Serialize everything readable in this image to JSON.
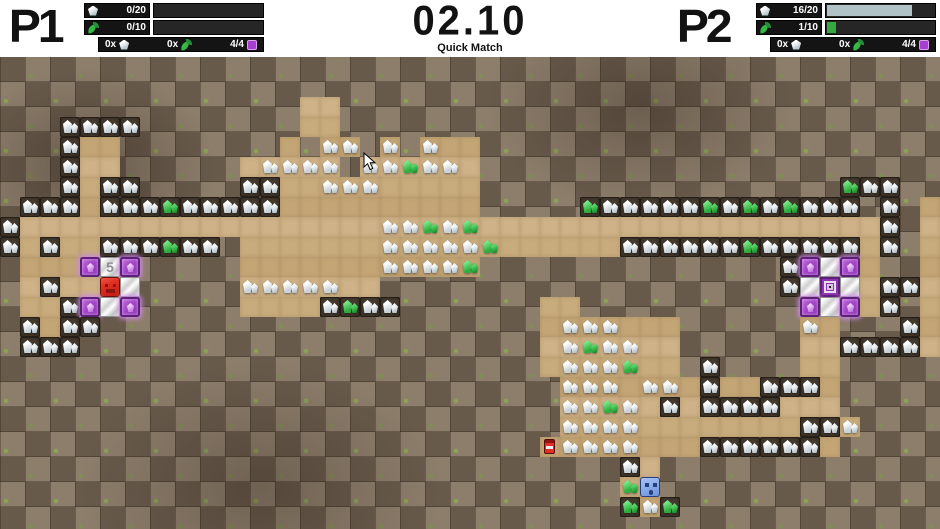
{
  "hud": {
    "timer": "02.10",
    "mode": "Quick Match",
    "p1": {
      "label": "P1",
      "gem": {
        "value": "0/20",
        "fill_pct": 0,
        "fill_color": "#b0c2c6"
      },
      "leaf": {
        "value": "0/10",
        "fill_pct": 0,
        "fill_color": "#35a93f"
      },
      "inv": {
        "gems": "0x",
        "leaves": "0x",
        "blocks": "4/4"
      }
    },
    "p2": {
      "label": "P2",
      "gem": {
        "value": "16/20",
        "fill_pct": 80,
        "fill_color": "#b0c2c6"
      },
      "leaf": {
        "value": "1/10",
        "fill_pct": 10,
        "fill_color": "#35a93f"
      },
      "inv": {
        "gems": "0x",
        "leaves": "0x",
        "blocks": "4/4"
      }
    },
    "icons": {
      "gem": "gem-icon",
      "leaf": "leaf-icon",
      "block": "block-icon"
    }
  },
  "board": {
    "cols": 47,
    "rows": 24,
    "tile": 20,
    "five_label": "5",
    "legend": {
      "D": "dirt",
      "S": "dug-sand",
      "w": "white-gem-on-sand",
      "g": "green-gem-on-sand",
      "W": "white-gem-in-dirt",
      "G": "green-gem-in-dirt",
      "P": "purple-crystal-block",
      "M": "marble-block",
      "5": "numbered-marble-block",
      "C": "base-center-marker",
      "R": "player-red",
      "B": "player-blue",
      "t": "tnt-canister"
    },
    "map": [
      "DDDDDDDDDDDDDDDDDDDDDDDDDDDDDDDDDDDDDDDDDDDDDDD",
      "DDDDDDDDDDDDDDDDDDDDDDDDDDDDDDDDDDDDDDDDDDDDDDD",
      "DDDDDDDDDDDDDDDSSDDDDDDDDDDDDDDDDDDDDDDDDDDDDDD",
      "DDDWWWWDDDDDDDDSSDDDDDDDDDDDDDDDDDDDDDDDDDDDDDD",
      "DDDWSSDDDDDDDDSDwwDwDwSSDDDDDDDDDDDDDDDDDDDDDDD",
      "DDDWSSDDDDDDSwwwwDwwgwwSDDDDDDDDDDDDDDDDDDDDDDD",
      "DDDWSWWDDDDDWWSSwwwSSSSSDDDDDDDDDDDDDDDDDDGWWDD",
      "DWWWSWWWGWWWWWSSSSSSSSSSDDDDDGWWWWWGWGWGWWWDWDS",
      "WSSSSSSSSSSSSSSSSSSwwgwgSSSSSSSSSSSSSSSSSSSSWDS",
      "WSWSSWWWGWWDSSSSSSSwwwwwgSSSSSSWWWWWWGWWWWWSWDS",
      "DSSSP5PDDDDDSSSSSSSwwwwgDDDDDDDDDDDDDDDWPMPSDDS",
      "DSWSSRMDDDDDwwwwwSSDDDDDDDDDDDDDDDDDDDDWMCMSWWS",
      "DSSWPMPDDDDDSSSSWGWWDDDDDDDSSDDDDDDDDDDDPMPSWDS",
      "DWSWWDDDDDDDDDDDDDDDDDDDDDDSwwwSSSDDDDDDwSDDDWS",
      "DWWWDDDDDDDDDDDDDDDDDDDDDDDSwgwwSSDDDDDDSSWWWWS",
      "DDDDDDDDDDDDDDDDDDDDDDDDDDDSwwwgSSDWDDDDSSDDDDD",
      "DDDDDDDDDDDDDDDDDDDDDDDDDDDDwwwSwwSWSSWWWSDDDDD",
      "DDDDDDDDDDDDDDDDDDDDDDDDDDDDwwgwSWSWWWWSSSDDDDD",
      "DDDDDDDDDDDDDDDDDDDDDDDDDDDDwwwwSSSSSSSSWWwDDDD",
      "DDDDDDDDDDDDDDDDDDDDDDDDDDDtwwwwSSSWWWWWWSDDDDD",
      "DDDDDDDDDDDDDDDDDDDDDDDDDDDDDDDWSDDDDDDDDDDDDDD",
      "DDDDDDDDDDDDDDDDDDDDDDDDDDDDDDDgBDDDDDDDDDDDDDD",
      "DDDDDDDDDDDDDDDDDDDDDDDDDDDDDDDGwGDDDDDDDDDDDDD",
      "DDDDDDDDDDDDDDDDDDDDDDDDDDDDDDDDDDDDDDDDDDDDDDD"
    ]
  },
  "cursor": {
    "x": 363,
    "y": 152
  }
}
